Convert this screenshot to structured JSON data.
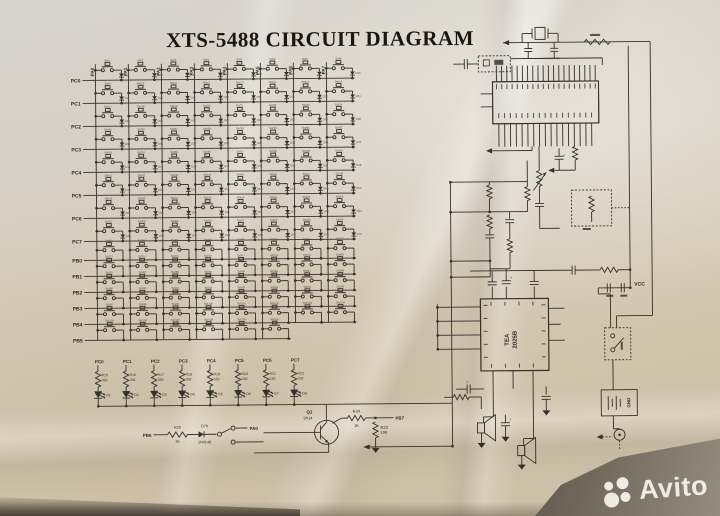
{
  "title": "XTS-5488 CIRCUIT DIAGRAM",
  "watermark": "Avito",
  "key_matrix": {
    "column_labels": [
      "PA0",
      "PA1",
      "PA2",
      "PA3",
      "PA4",
      "PA5",
      "PA6",
      "PA7"
    ],
    "rows": [
      {
        "label": "PC0",
        "cells": 8,
        "diodes": true
      },
      {
        "label": "PC1",
        "cells": 8,
        "diodes": true
      },
      {
        "label": "PC2",
        "cells": 8,
        "diodes": true
      },
      {
        "label": "PC3",
        "cells": 8,
        "diodes": true
      },
      {
        "label": "PC4",
        "cells": 8,
        "diodes": true
      },
      {
        "label": "PC5",
        "cells": 8,
        "diodes": true
      },
      {
        "label": "PC6",
        "cells": 8,
        "diodes": true
      },
      {
        "label": "PC7",
        "cells": 8,
        "diodes": true
      },
      {
        "label": "PB0",
        "cells": 8,
        "diodes": false
      },
      {
        "label": "PB1",
        "cells": 8,
        "diodes": false
      },
      {
        "label": "PB2",
        "cells": 8,
        "diodes": false
      },
      {
        "label": "PB3",
        "cells": 8,
        "diodes": false
      },
      {
        "label": "PB4",
        "cells": 8,
        "diodes": false
      },
      {
        "label": "PB5",
        "cells": 6,
        "diodes": false
      }
    ],
    "switch_prefix": "SW",
    "diode_prefix": "D"
  },
  "led_array": {
    "columns": [
      {
        "port": "PC0",
        "resistor": "R15",
        "value": "330",
        "led": "D1"
      },
      {
        "port": "PC1",
        "resistor": "R16",
        "value": "330",
        "led": "D2"
      },
      {
        "port": "PC2",
        "resistor": "R17",
        "value": "330",
        "led": "D3"
      },
      {
        "port": "PC3",
        "resistor": "R18",
        "value": "330",
        "led": "D4"
      },
      {
        "port": "PC4",
        "resistor": "R19",
        "value": "330",
        "led": "D5"
      },
      {
        "port": "PC5",
        "resistor": "R20",
        "value": "330",
        "led": "D6"
      },
      {
        "port": "PC6",
        "resistor": "R21",
        "value": "330",
        "led": "D7"
      },
      {
        "port": "PC7",
        "resistor": "R22",
        "value": "330",
        "led": "D8"
      }
    ]
  },
  "driver": {
    "pb6_label": "PB6",
    "r25": {
      "name": "R25",
      "value": "1K"
    },
    "d70": {
      "name": "D70",
      "value": "1N4148"
    },
    "pa0_label": "PA0",
    "q1": {
      "name": "Q1",
      "value": "9014"
    },
    "r24": {
      "name": "R24",
      "value": "1K"
    },
    "pb7_label": "PB7",
    "r23": {
      "name": "R23",
      "value": "10K"
    }
  },
  "amplifier": {
    "ic_line1": "TEA",
    "ic_line2": "2025B"
  },
  "power": {
    "vcc_label": "VCC",
    "gnd_label": "GND"
  },
  "colors": {
    "ink": "#34302a",
    "ink_faint": "#555044",
    "paper": "#d3c9b8"
  }
}
